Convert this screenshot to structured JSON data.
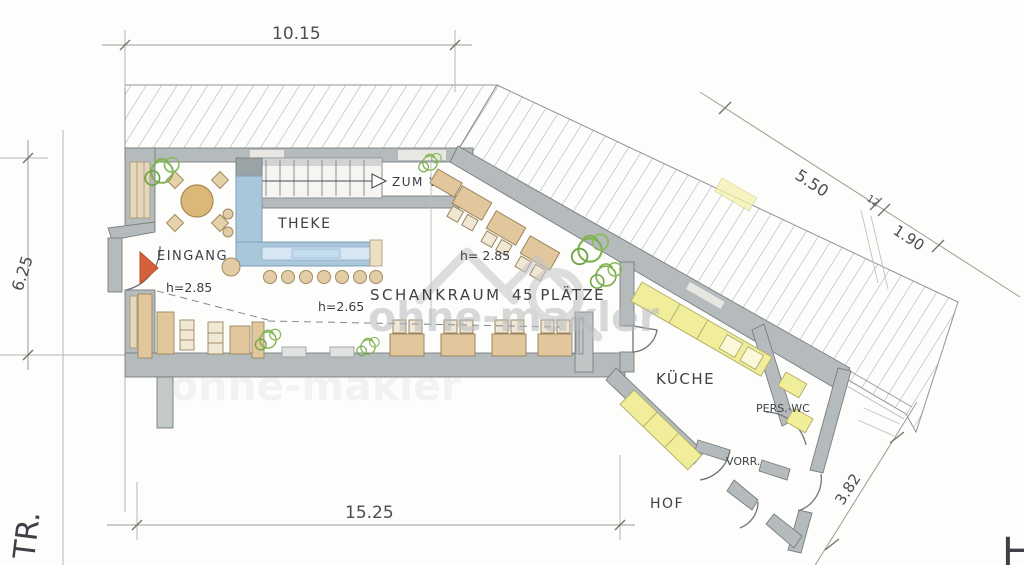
{
  "drawing": {
    "type": "hand-drawn floor plan of a pub (Schankwirtschaft) with courtyard",
    "watermark_text": "ohne-makler",
    "dimensions": {
      "top": "10.15",
      "left": "6.25",
      "bottom": "15.25",
      "diagonal_a": "5.50",
      "diagonal_small": "12",
      "diagonal_b": "1.90",
      "diagonal_c": "3.82"
    },
    "room_labels": {
      "entrance": "EINGANG",
      "bar": "THEKE",
      "to_wc": "ZUM WC",
      "tap_room": "SCHANKRAUM",
      "tap_room_seats": "45 PLÄTZE",
      "kitchen": "KÜCHE",
      "staff_wc": "PERS.-WC",
      "storage": "VORR.",
      "courtyard": "HOF"
    },
    "height_labels": {
      "entrance": "h=2.85",
      "tap_room_front": "h=2.65",
      "tap_room_rear": "h= 2.85"
    },
    "edge_labels": {
      "street": "TR.",
      "corner": "H"
    },
    "colors": {
      "wall": "#b5bbbc",
      "hatch": "#a9acaf",
      "bar_counter": "#aac6da",
      "bar_counter_top": "#d6e6f2",
      "kitchen_counter": "#f1ee9b",
      "furniture": "#e2c79c",
      "plant": "#7fb24f",
      "door_marker": "#d4603c",
      "watermark": "#b7babd",
      "pencil": "#6d7479"
    }
  }
}
